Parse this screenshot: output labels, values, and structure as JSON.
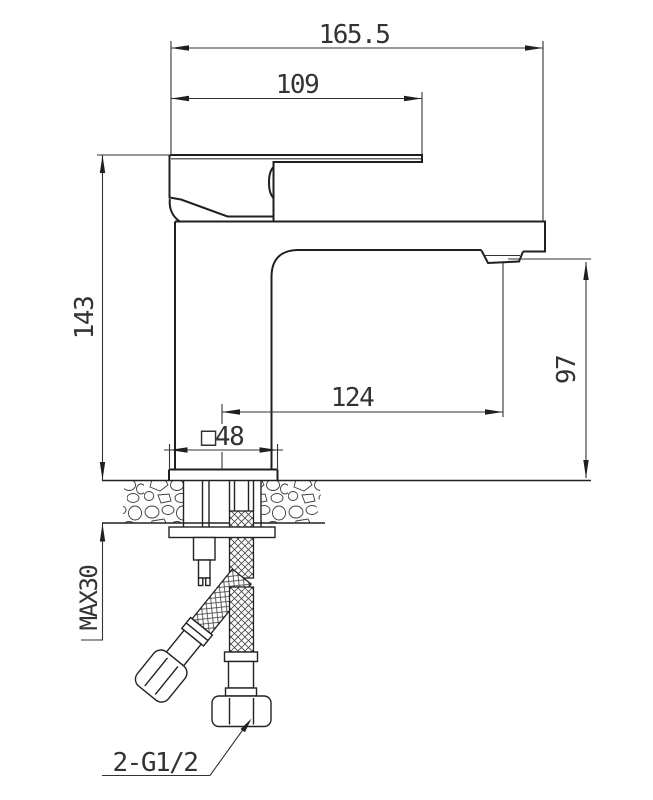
{
  "drawing": {
    "kind": "basin mixer faucet installation dimension drawing",
    "colors": {
      "line": "#1f1f1f",
      "dim_line": "#333333",
      "background": "#ffffff"
    },
    "dimensions": {
      "overall_length": "165.5",
      "handle_length": "109",
      "height_to_deck": "143",
      "spout_reach": "124",
      "spout_outlet_height": "97",
      "base_square": "□48",
      "max_deck_thickness": "MAX30",
      "hose_thread_spec": "2-G1/2"
    }
  }
}
